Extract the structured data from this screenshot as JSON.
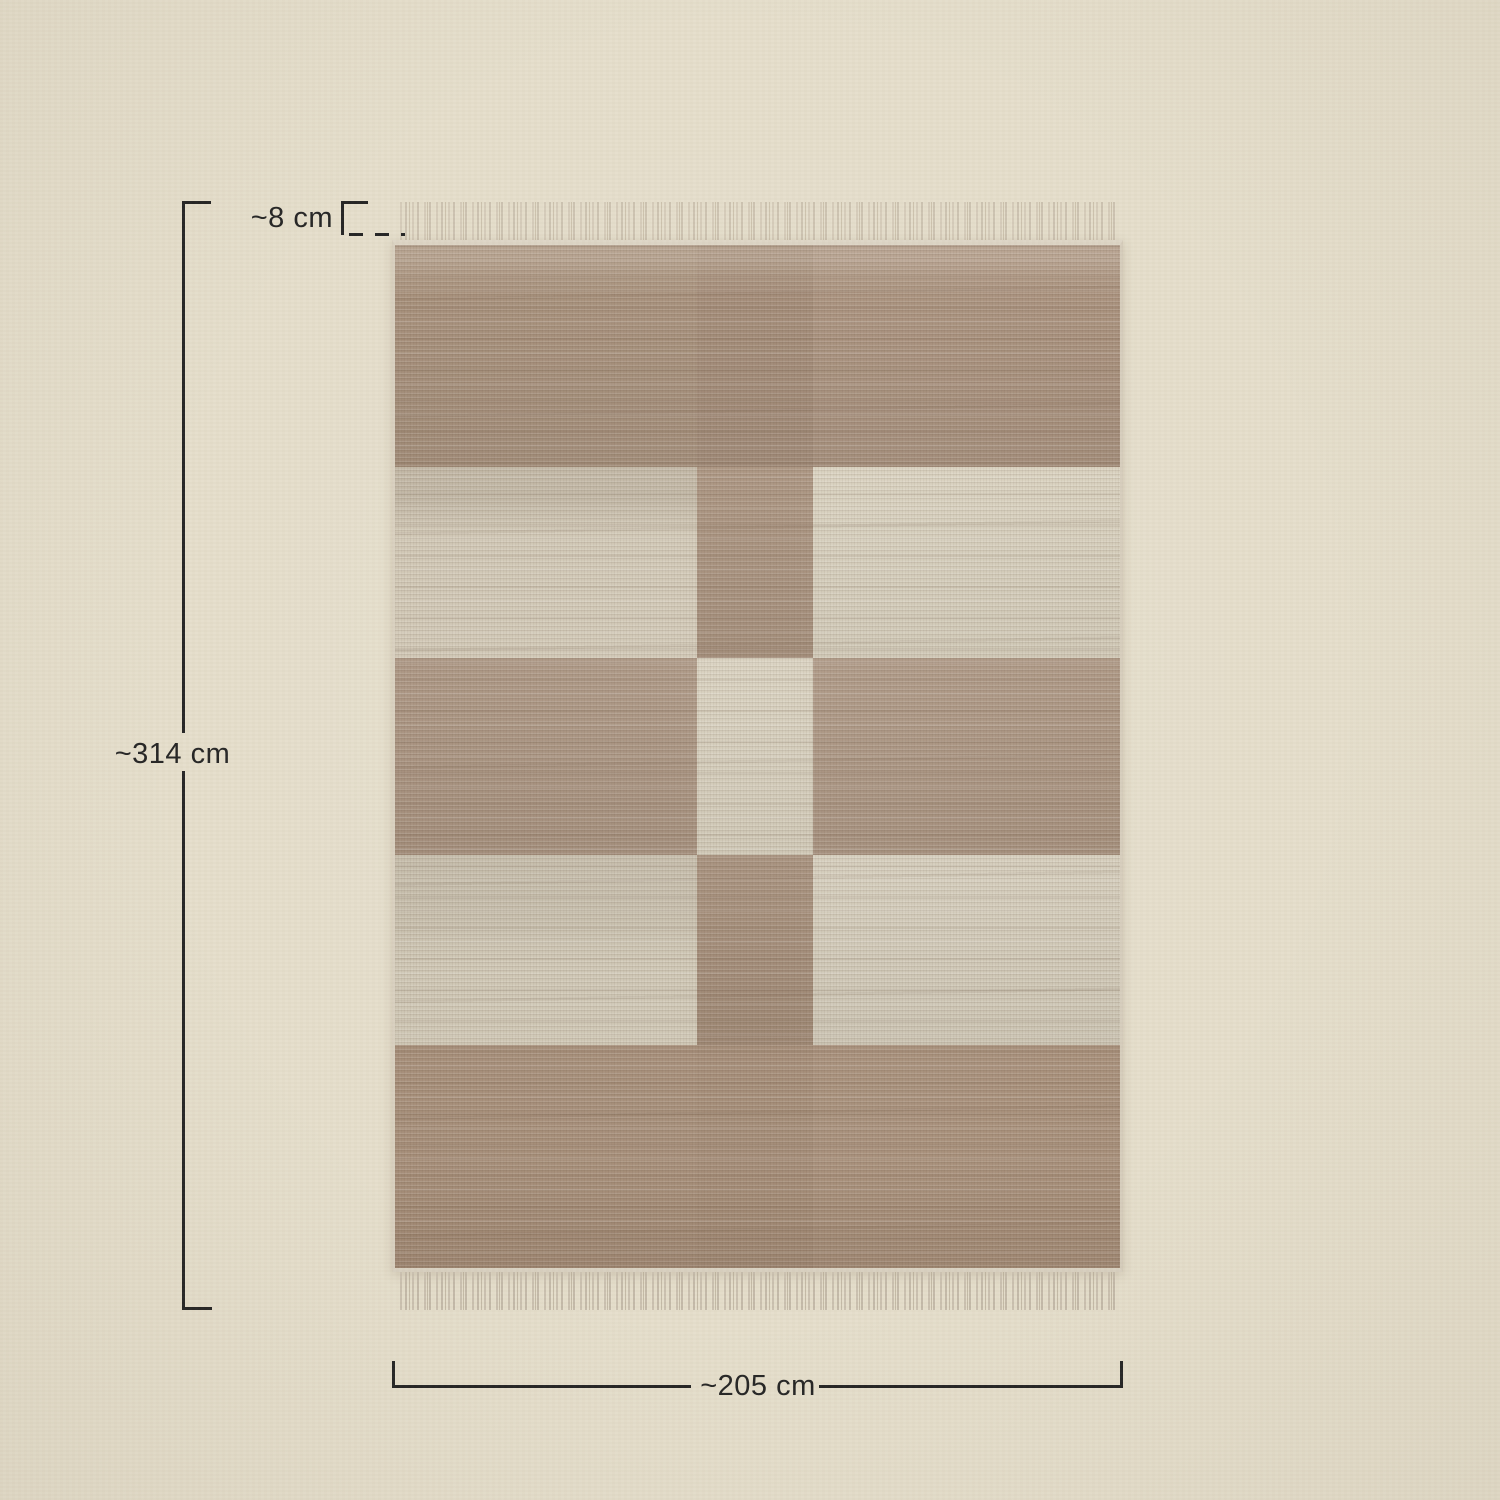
{
  "scene": {
    "background_color": "#e5decb",
    "line_color": "#232323",
    "subject": "handwoven jute rug with beige and brown checkered block pattern and fringed short ends, shown flat with dimension lines"
  },
  "measurements": {
    "height_label": "~314 cm",
    "width_label": "~205 cm",
    "fringe_label": "~8 cm"
  },
  "rug": {
    "fringe_color": "#d4cab8",
    "columns_px": [
      305,
      116,
      310
    ],
    "rows_px": [
      224,
      193,
      198,
      192,
      225
    ],
    "cells": [
      [
        "#a7907b",
        "#a38b77",
        "#aa927e"
      ],
      [
        "#d1c8b6",
        "#a68e79",
        "#d8d0bd"
      ],
      [
        "#a8917d",
        "#d7cfbc",
        "#aa937f"
      ],
      [
        "#cfc7b5",
        "#a28a75",
        "#d4ccba"
      ],
      [
        "#a68e79",
        "#a48c77",
        "#a8907b"
      ]
    ]
  }
}
